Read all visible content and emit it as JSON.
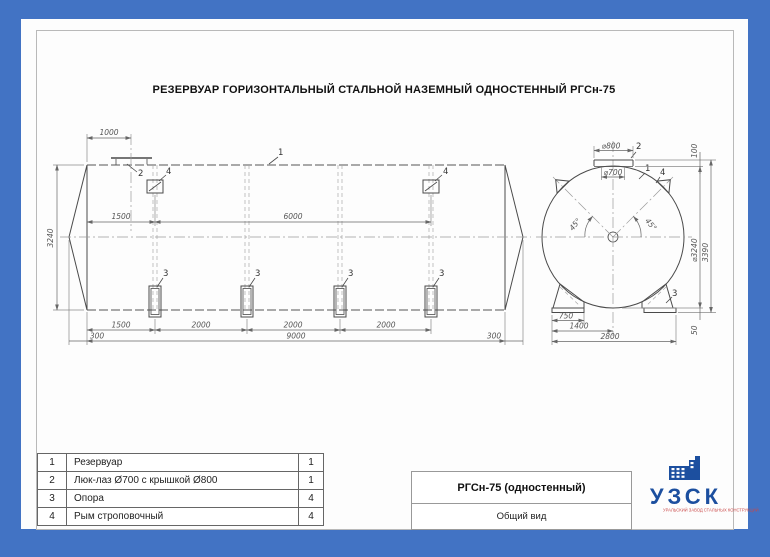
{
  "drawing": {
    "title": "РЕЗЕРВУАР ГОРИЗОНТАЛЬНЫЙ СТАЛЬНОЙ НАЗЕМНЫЙ ОДНОСТЕННЫЙ РГСн-75"
  },
  "side_view": {
    "dim_1000": "1000",
    "dim_1500_top": "1500",
    "dim_6000": "6000",
    "dim_3240": "3240",
    "dim_1500_bottom": "1500",
    "dim_2000_a": "2000",
    "dim_2000_b": "2000",
    "dim_2000_c": "2000",
    "dim_300_left": "300",
    "dim_9000": "9000",
    "dim_300_right": "300",
    "label_1": "1",
    "label_2": "2",
    "label_3": "3",
    "label_4": "4"
  },
  "end_view": {
    "dim_d800": "⌀800",
    "dim_d700": "⌀700",
    "dim_100": "100",
    "dim_d3240": "⌀3240",
    "dim_3390": "3390",
    "dim_50": "50",
    "dim_750": "750",
    "dim_1400": "1400",
    "dim_2800": "2800",
    "angle_left": "45°",
    "angle_right": "45°",
    "label_1": "1",
    "label_2": "2",
    "label_3": "3",
    "label_4": "4"
  },
  "parts_table": {
    "rows": [
      {
        "num": "1",
        "name": "Резервуар",
        "qty": "1"
      },
      {
        "num": "2",
        "name": "Люк-лаз Ø700 с крышкой Ø800",
        "qty": "1"
      },
      {
        "num": "3",
        "name": "Опора",
        "qty": "4"
      },
      {
        "num": "4",
        "name": "Рым строповочный",
        "qty": "4"
      }
    ]
  },
  "title_block": {
    "model": "РГСн-75 (одностенный)",
    "view_name": "Общий вид"
  },
  "logo": {
    "name": "УЗСК",
    "tagline": "УРАЛЬСКИЙ ЗАВОД СТАЛЬНЫХ КОНСТРУКЦИЙ"
  },
  "colors": {
    "border_blue": "#4273c4",
    "logo_blue": "#1c4f9f",
    "logo_red": "#c94747",
    "line_dark": "#4a4a4a"
  }
}
